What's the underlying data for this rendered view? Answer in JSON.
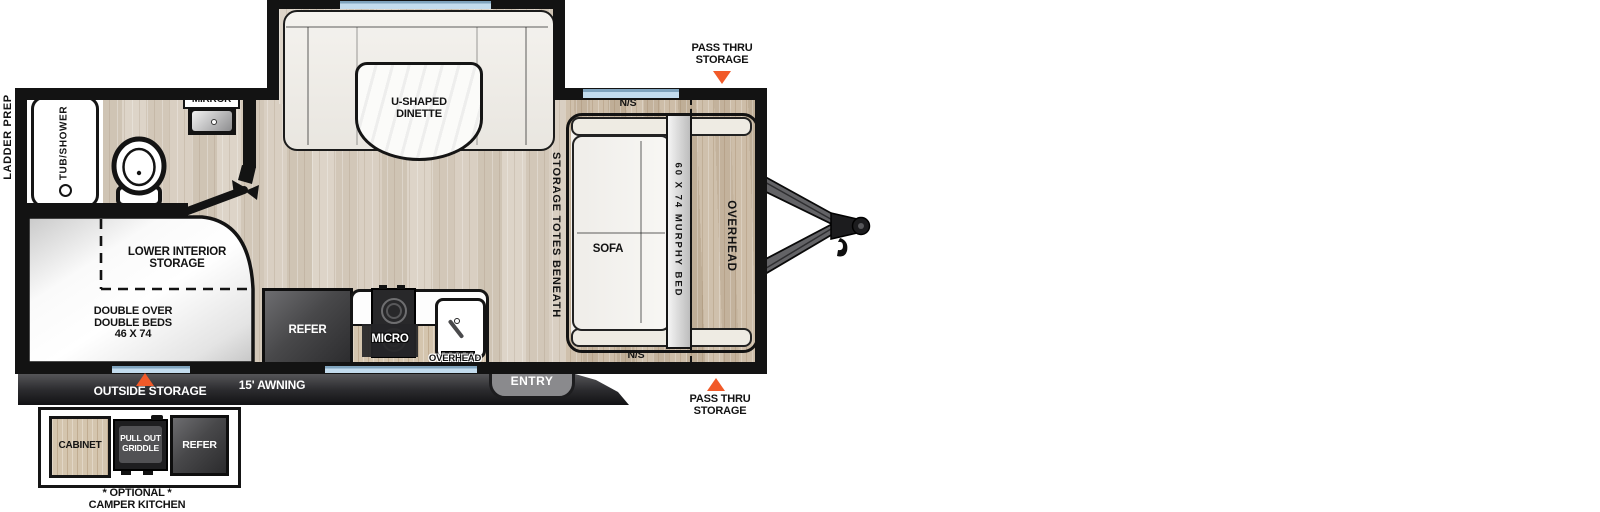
{
  "title": "Travel trailer floor plan",
  "colors": {
    "wall": "#131313",
    "accent_orange": "#f15a29",
    "window_blue": "#c3dcee",
    "floor_wood": "#d9d0c4",
    "front_wood": "#cbbca8",
    "dark_appliance": "#48484a",
    "bar_gray": "#2b2b2e"
  },
  "icons": {
    "pass_thru_marker": "orange-triangle",
    "outside_storage_marker": "orange-triangle",
    "toilet": "toilet-top-view",
    "bath_sink": "sink-top-view",
    "kitchen_sink": "sink-top-view",
    "cooktop": "two-burner-cooktop",
    "bathroom_door": "open-door-swing",
    "shower_head": "circle",
    "hitch": "trailer-tongue-hitch"
  },
  "labels": {
    "ladder_prep": "LADDER PREP",
    "tub_shower": "TUB/SHOWER",
    "mirror": "MIRROR",
    "dinette_1": "U-SHAPED",
    "dinette_2": "DINETTE",
    "pass_thru_1": "PASS THRU",
    "pass_thru_2": "STORAGE",
    "ns": "N/S",
    "storage_totes": "STORAGE TOTES BENEATH",
    "sofa": "SOFA",
    "murphy_bed": "60 X 74 MURPHY BED",
    "overhead": "OVERHEAD",
    "lower_interior_1": "LOWER INTERIOR",
    "lower_interior_2": "STORAGE",
    "double_beds_1": "DOUBLE OVER",
    "double_beds_2": "DOUBLE BEDS",
    "double_beds_3": "46 X 74",
    "refer": "REFER",
    "micro": "MICRO",
    "entry": "ENTRY",
    "awning": "15' AWNING",
    "outside_storage": "OUTSIDE STORAGE",
    "cabinet": "CABINET",
    "pull_out_1": "PULL OUT",
    "pull_out_2": "GRIDDLE",
    "optional_1": "* OPTIONAL *",
    "optional_2": "CAMPER KITCHEN"
  }
}
